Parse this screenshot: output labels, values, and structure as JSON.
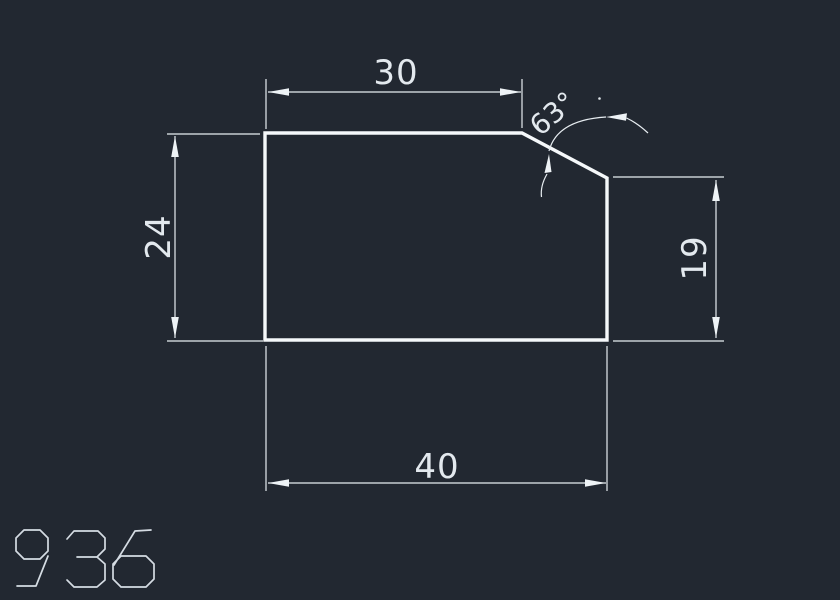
{
  "window": {
    "background": "#222831"
  },
  "palette": {
    "part_outline": "#f5f8fa",
    "dimension_lines": "#e7edf1",
    "dimension_text": "#e3e9ee",
    "stencil_text": "#d5dce3"
  },
  "drawing_number": "936",
  "dimensions": {
    "top_width": {
      "label": "30",
      "orientation": "horizontal"
    },
    "chamfer_angle": {
      "label": "63°",
      "orientation": "rotated"
    },
    "left_height": {
      "label": "24",
      "orientation": "vertical"
    },
    "right_height": {
      "label": "19",
      "orientation": "vertical"
    },
    "bottom_width": {
      "label": "40",
      "orientation": "horizontal"
    }
  }
}
